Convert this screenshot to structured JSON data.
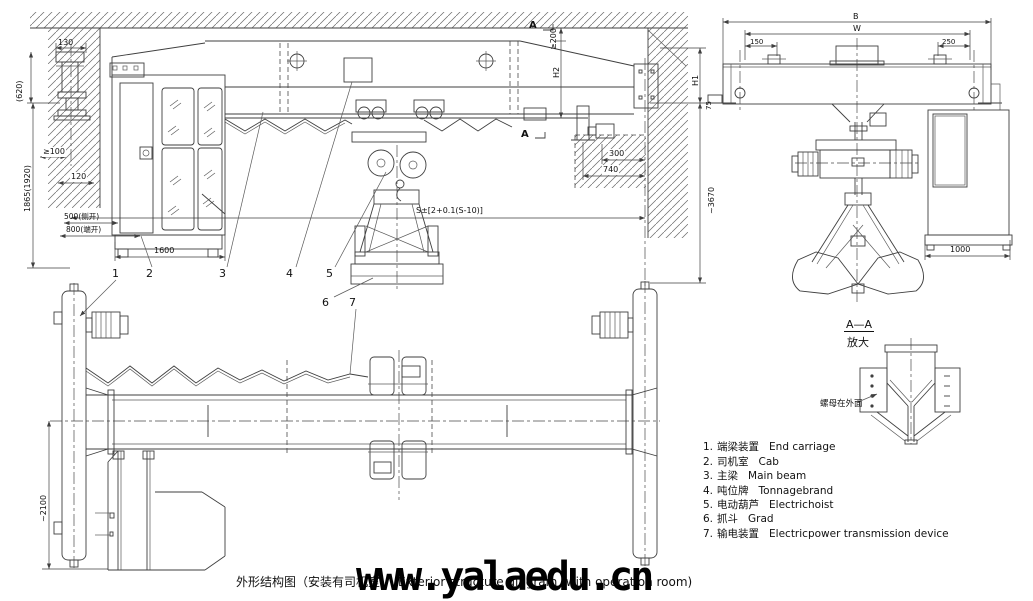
{
  "drawing": {
    "caption_cn": "外形结构图（安装有司机室）",
    "caption_en": "Exterior structure diagram (with operation room)",
    "watermark": "www.yalaedu.cn"
  },
  "legend": {
    "items": [
      {
        "num": "1.",
        "cn": "端梁装置",
        "en": "End carriage"
      },
      {
        "num": "2.",
        "cn": "司机室",
        "en": "Cab"
      },
      {
        "num": "3.",
        "cn": "主梁",
        "en": "Main beam"
      },
      {
        "num": "4.",
        "cn": "吨位牌",
        "en": "Tonnagebrand"
      },
      {
        "num": "5.",
        "cn": "电动葫芦",
        "en": "Electrichoist"
      },
      {
        "num": "6.",
        "cn": "抓斗",
        "en": "Grad"
      },
      {
        "num": "7.",
        "cn": "输电装置",
        "en": "Electricpower transmission device"
      }
    ]
  },
  "detail_view": {
    "title": "A—A",
    "subtitle": "放大",
    "note": "螺母在外面"
  },
  "section_marks": {
    "top": "A",
    "bottom": "A"
  },
  "parts": [
    "1",
    "2",
    "3",
    "4",
    "5",
    "6",
    "7"
  ],
  "dims": {
    "d130": "130",
    "d620": "(620)",
    "d1865": "1865(1920)",
    "ge100": "≥100",
    "d120": "120",
    "d500": "500(侧开)",
    "d800": "800(端开)",
    "d1600": "1600",
    "span": "S±[2+0.1(S-10)]",
    "ge200": "≥200",
    "h2": "H2",
    "h1": "H1",
    "d75": "75",
    "d300": "300",
    "d740": "740",
    "d3670": "~3670",
    "d2100": "~2100",
    "B": "B",
    "W": "W",
    "d150": "150",
    "d250": "250",
    "d1000": "1000"
  },
  "colors": {
    "line": "#3f3f3f",
    "text": "#111111",
    "watermark": "#000000",
    "paper": "#ffffff"
  }
}
